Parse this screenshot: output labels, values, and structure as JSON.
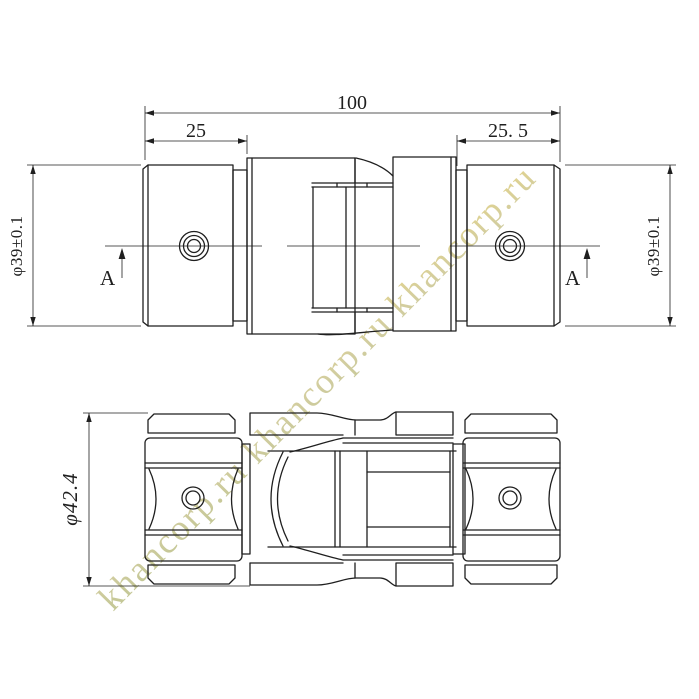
{
  "colors": {
    "line": "#1f1f1f",
    "background": "#ffffff"
  },
  "watermark": {
    "text": "khancorp.ru  khancorp.ru  khancorp.ru",
    "opacity": "0.6",
    "gradient": [
      "#96a04d",
      "#b5ad62",
      "#d8ba3b"
    ]
  },
  "top_view": {
    "dim_overall_length": "100",
    "dim_left_hub_length": "25",
    "dim_right_hub_length": "25. 5",
    "dim_left_diameter": "φ39±0.1",
    "dim_right_diameter": "φ39±0.1",
    "section_arrow_left": "A",
    "section_arrow_right": "A"
  },
  "bottom_view": {
    "dim_outer_diameter": "φ42.4"
  }
}
